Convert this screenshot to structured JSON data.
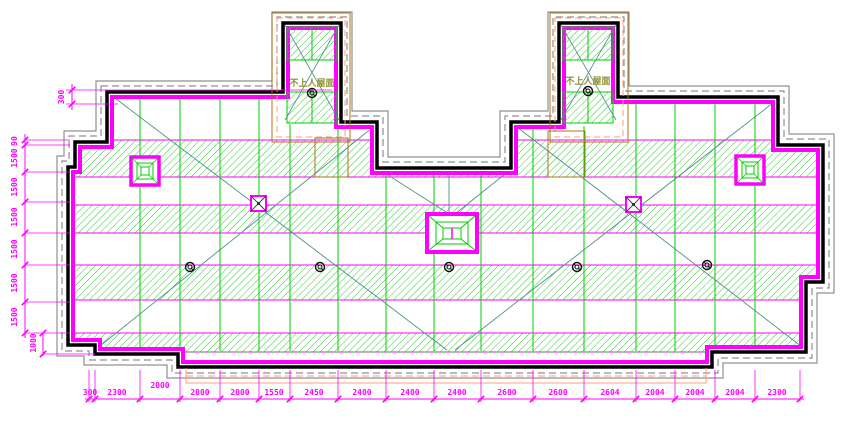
{
  "drawing": {
    "notes": {
      "left_tower": "不上人屋面",
      "right_tower": "不上人屋面"
    },
    "dimensions": {
      "top_left": "300",
      "left": [
        "90",
        "1500",
        "1500",
        "1500",
        "1500",
        "1500",
        "1500",
        "1000"
      ],
      "bottom": [
        "300",
        "2300",
        "2000",
        "2000",
        "2000",
        "1550",
        "2450",
        "2400",
        "2400",
        "2400",
        "2600",
        "2600",
        "2604",
        "2004",
        "2004",
        "2004",
        "2300"
      ]
    },
    "colors": {
      "parapet_inner": "#FF00FF",
      "parapet_outer": "#000000",
      "offset_line": "#909090",
      "hatch_green": "#2ECC2E",
      "panel_green": "#00CC00",
      "slope_line": "#4E8F8F",
      "tower_box": "#A8741A",
      "flashing": "#FF9E79",
      "dimension_text": "#FF00FF",
      "note_text": "#8F8F30"
    }
  }
}
